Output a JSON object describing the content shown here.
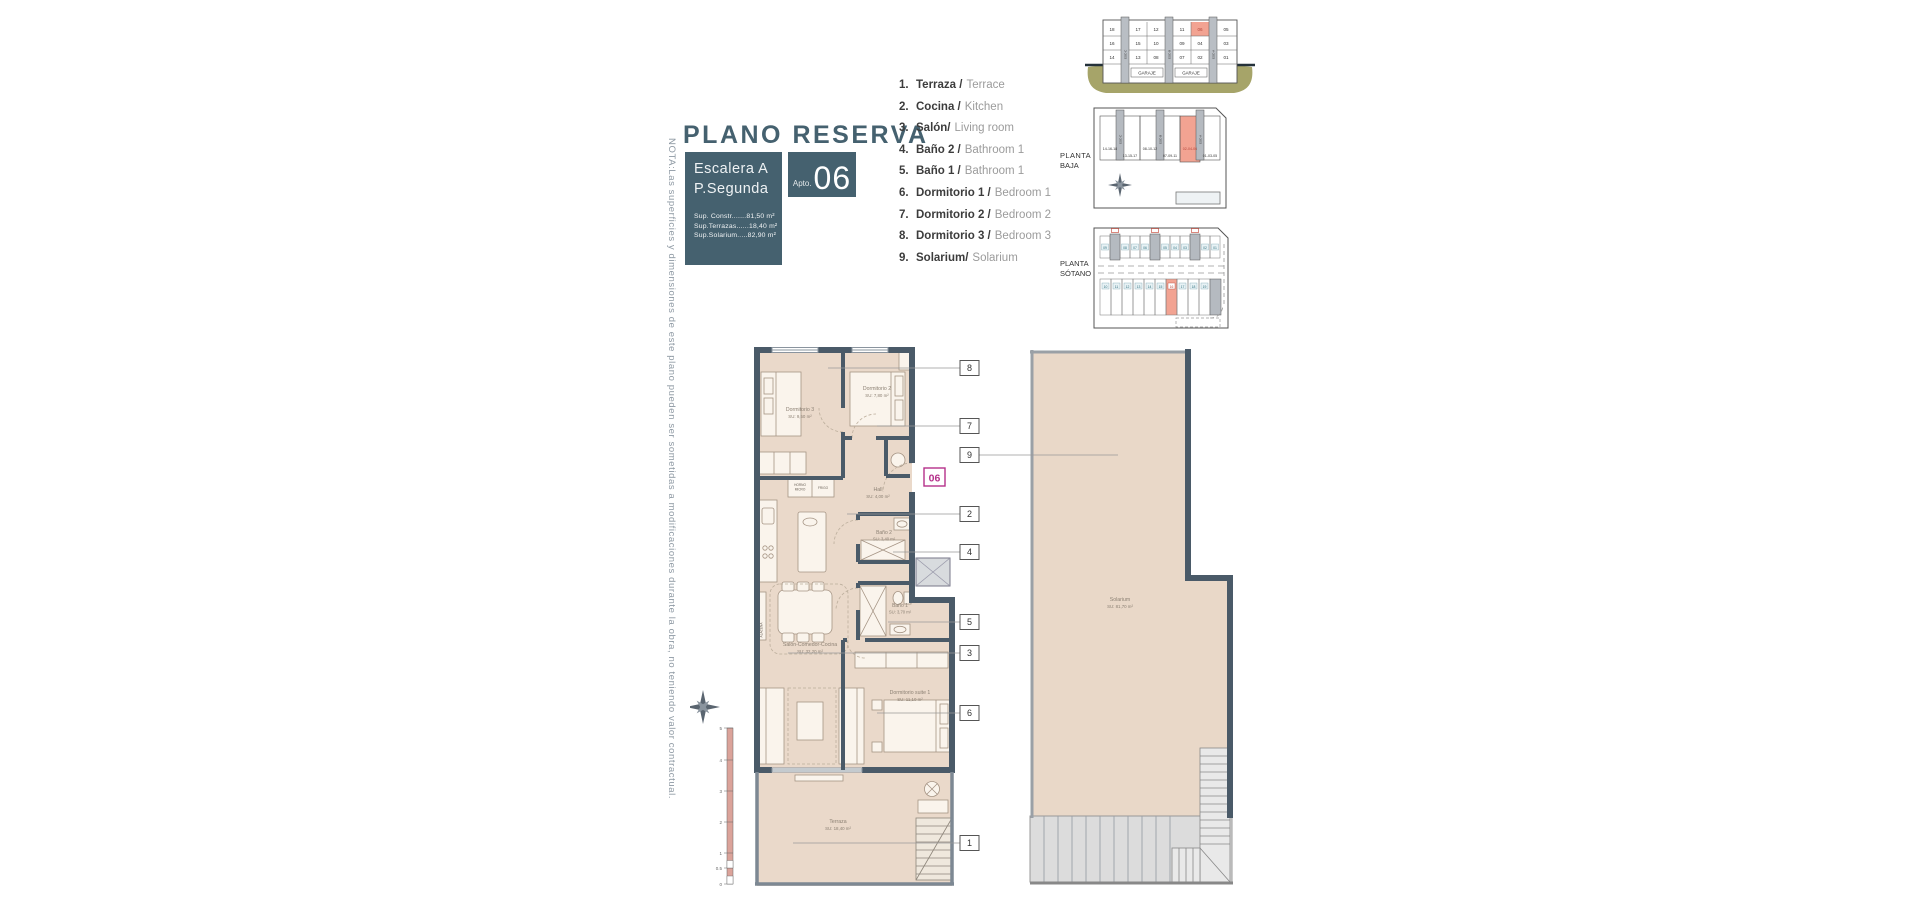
{
  "title": "PLANO RESERVA",
  "nota": "NOTA:Las superficies y dimensiones de este plano pueden ser sometidas a modificaciones durante la obra, no teniendo valor contractual.",
  "title_block": {
    "escalera": "Escalera A",
    "planta": "P.Segunda",
    "apto_label": "Apto.",
    "apto_number": "06",
    "sup_constr": "Sup. Constr.......81,50 m²",
    "sup_terrazas": "Sup.Terrazas......18,40 m²",
    "sup_solarium": "Sup.Solarium.....82,90 m²"
  },
  "legend": {
    "items": [
      {
        "num": "1.",
        "es": "Terraza /",
        "en": "Terrace"
      },
      {
        "num": "2.",
        "es": "Cocina /",
        "en": "Kitchen"
      },
      {
        "num": "3.",
        "es": "Salón/",
        "en": "Living room"
      },
      {
        "num": "4.",
        "es": "Baño 2 /",
        "en": "Bathroom 1"
      },
      {
        "num": "5.",
        "es": "Baño 1 /",
        "en": "Bathroom 1"
      },
      {
        "num": "6.",
        "es": "Dormitorio 1 /",
        "en": "Bedroom 1"
      },
      {
        "num": "7.",
        "es": "Dormitorio 2 /",
        "en": "Bedroom 2"
      },
      {
        "num": "8.",
        "es": "Dormitorio 3 /",
        "en": "Bedroom 3"
      },
      {
        "num": "9.",
        "es": "Solarium/",
        "en": "Solarium"
      }
    ]
  },
  "diagrams": {
    "section": {
      "rows": [
        [
          "18",
          "17",
          "12",
          "11",
          "06",
          "05"
        ],
        [
          "16",
          "15",
          "10",
          "09",
          "04",
          "03"
        ],
        [
          "14",
          "13",
          "08",
          "07",
          "02",
          "01"
        ]
      ],
      "garage": "GARAJE",
      "esc": [
        "ESC-C",
        "ESC-B",
        "ESC-A"
      ]
    },
    "baja": {
      "label1": "PLANTA",
      "label2": "BAJA",
      "cells": [
        "14-16-18",
        "13-15-17",
        "08-10-12",
        "07-09-11",
        "02-04-06",
        "01-03-05"
      ],
      "esc": [
        "ESC-C",
        "ESC-B",
        "ESC-A"
      ]
    },
    "sotano": {
      "label1": "PLANTA",
      "label2": "SÓTANO",
      "top": [
        "09",
        "08",
        "07",
        "06",
        "05",
        "04",
        "03",
        "02",
        "01"
      ],
      "bottom": [
        "10",
        "11",
        "12",
        "13",
        "14",
        "15",
        "16",
        "17",
        "18",
        "19"
      ]
    }
  },
  "plan": {
    "apto_tag": "06",
    "rooms": {
      "dorm3": {
        "name": "Dormitorio 3",
        "area": "SU: 9,50 m²"
      },
      "dorm2": {
        "name": "Dormitorio 2",
        "area": "SU: 7,80 m²"
      },
      "hall": {
        "name": "Hall",
        "area": "SU: 4,00 m²"
      },
      "bano2": {
        "name": "Baño 2",
        "area": "SU: 3,40 m²"
      },
      "bano1": {
        "name": "Baño 1",
        "area": "SU: 3,70 m²"
      },
      "salon": {
        "name": "Salón-Comedor-Cocina",
        "area": "SU: 32,20 m²"
      },
      "suite": {
        "name": "Dormitorio suite 1",
        "area": "SU: 11,10 m²"
      },
      "terraza": {
        "name": "Terraza",
        "area": "SU: 18,40 m²"
      },
      "solarium": {
        "name": "Solarium",
        "area": "SU: 81,70 m²"
      }
    },
    "kitchen": {
      "horno1": "HORNO",
      "horno2": "MICRO",
      "frigo": "FRIGO",
      "alacena": "ALACENA"
    },
    "callouts": {
      "n8": "8",
      "n7": "7",
      "n9": "9",
      "n2": "2",
      "n4": "4",
      "n5": "5",
      "n3": "3",
      "n6": "6",
      "n1": "1"
    },
    "scale": [
      "5",
      "4",
      "3",
      "2",
      "1",
      "0.5",
      "0"
    ]
  },
  "colors": {
    "slate": "#45616f",
    "wall": "#4a5a68",
    "floor": "#ead9ca",
    "salmon": "#f2a392",
    "olive": "#a6a469",
    "magenta": "#b5308a"
  }
}
